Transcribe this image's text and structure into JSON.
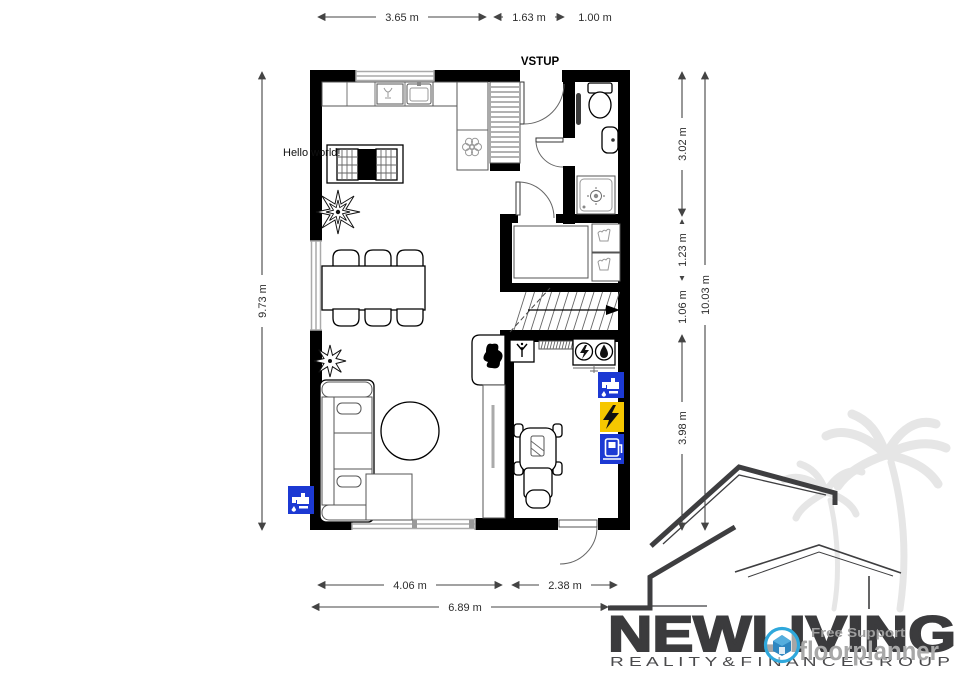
{
  "floorplan": {
    "entrance_label": "VSTUP",
    "annotation": "Hello world!",
    "dim_top": [
      "3.65 m",
      "1.63 m",
      "1.00 m"
    ],
    "dim_left": "9.73 m",
    "dim_right": [
      "3.02 m",
      "1.23 m",
      "1.06 m",
      "3.98 m"
    ],
    "dim_right_total": "10.03 m",
    "dim_bottom": [
      "4.06 m",
      "2.38 m"
    ],
    "dim_bottom_total": "6.89 m",
    "colors": {
      "wall": "#000000",
      "window_gray": "#aaaaaa",
      "water_blue": "#1c39d3",
      "energy_yellow": "#f6c700"
    },
    "icons": [
      "water-tap-icon",
      "electricity-icon",
      "ev-charger-icon",
      "electric-meter-icon",
      "water-meter-icon",
      "vent-icon",
      "toilet-icon",
      "washbasin-icon",
      "shower-icon",
      "washing-machine-icon",
      "dishwasher-icon",
      "sink-icon",
      "stove-icon",
      "plant-icon",
      "stroller-icon",
      "fireplace-icon",
      "radiator-icon",
      "stairs-arrow-icon"
    ]
  },
  "branding": {
    "company_name": "NEWLIVING",
    "company_tagline": "R E A L I T Y   &   F I N A N C E   G R O U P",
    "floorplanner_label": "floorplanner",
    "support_label": "Free Support",
    "colors": {
      "brand_dark": "#3b3b3d",
      "floorplanner_blue": "#2fa8dc",
      "watermark_gray": "#e6e6e6"
    }
  }
}
